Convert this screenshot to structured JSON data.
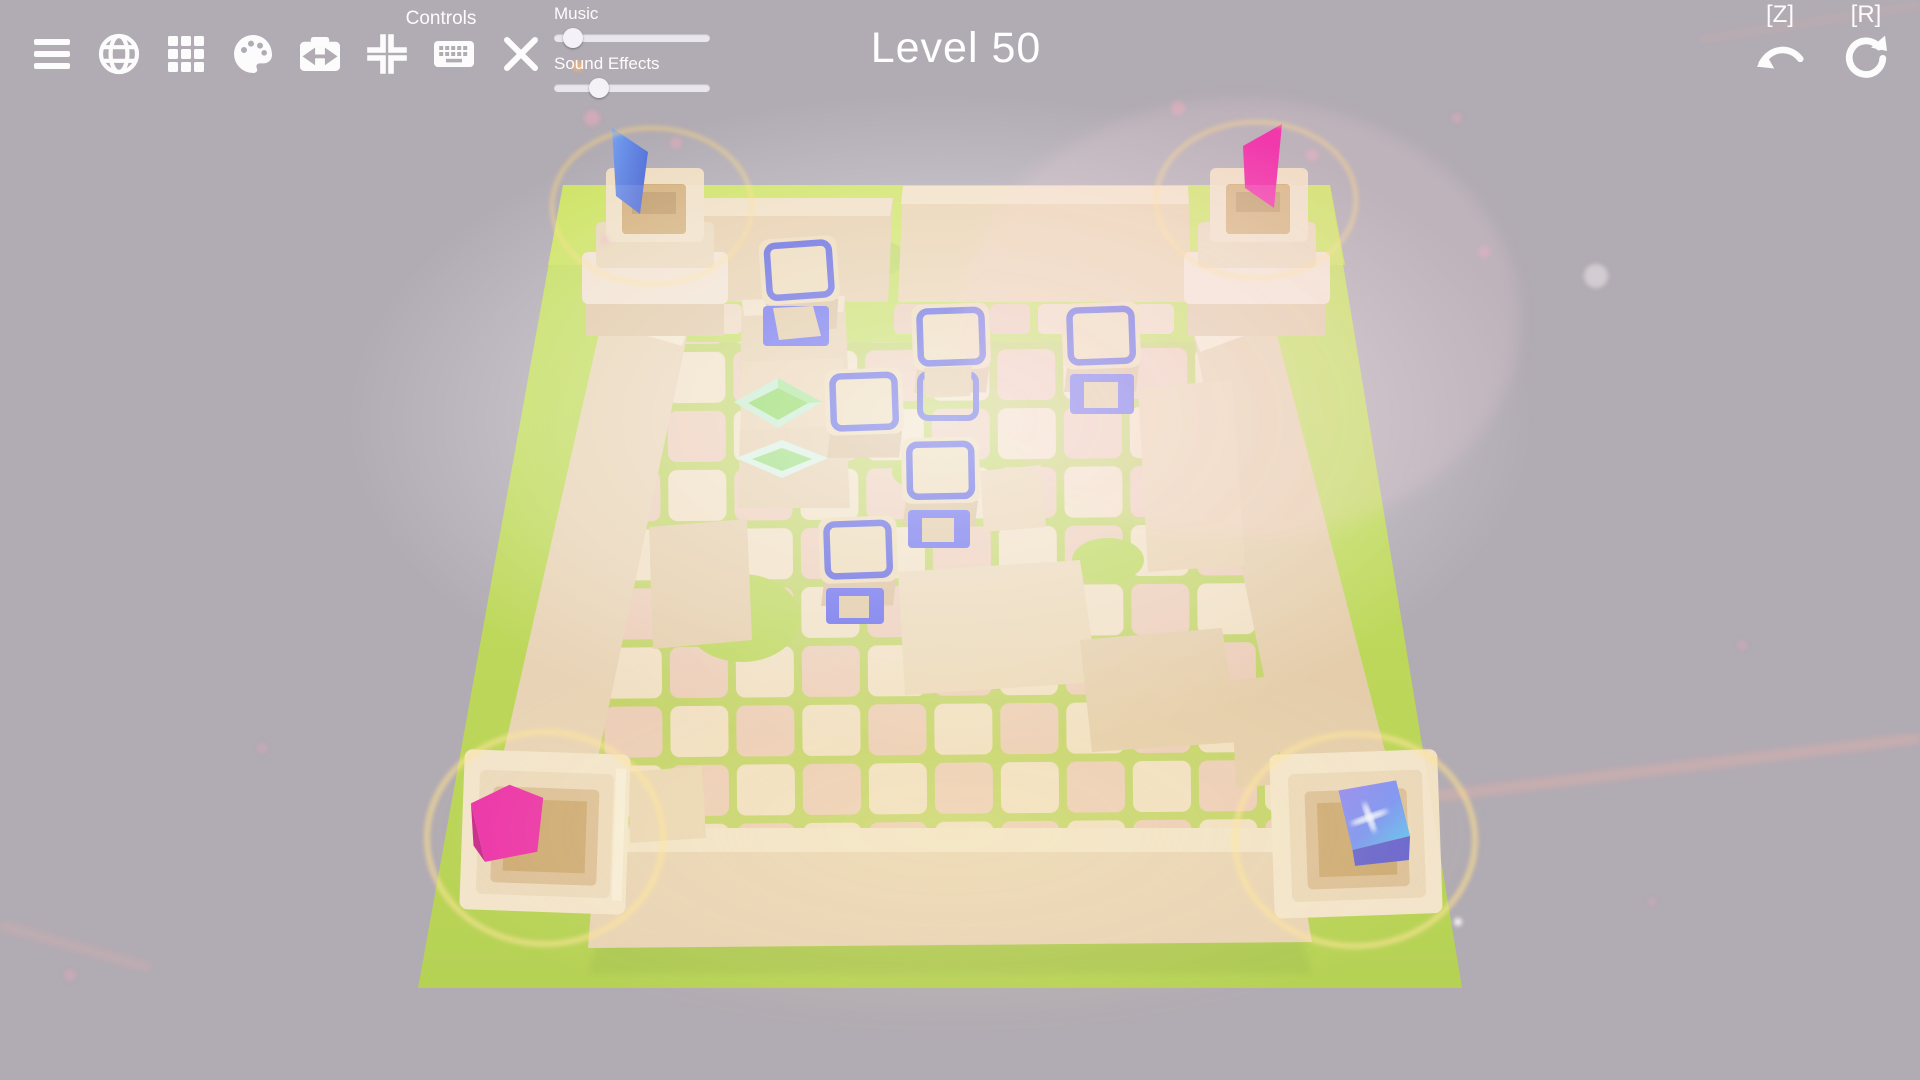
{
  "header": {
    "level_title": "Level 50"
  },
  "toolbar": {
    "controls_label": "Controls",
    "icons": [
      "menu",
      "globe",
      "grid",
      "palette",
      "camera-flip",
      "center-focus",
      "keyboard",
      "close"
    ]
  },
  "audio": {
    "music": {
      "label": "Music",
      "value_percent": 12
    },
    "sound_effects": {
      "label": "Sound Effects",
      "value_percent": 29
    }
  },
  "history": {
    "undo_key": "[Z]",
    "redo_key": "[R]"
  },
  "board": {
    "towers": [
      {
        "position": "top-left",
        "marker": "blue-flag"
      },
      {
        "position": "top-right",
        "marker": "pink-flag"
      },
      {
        "position": "bottom-left",
        "marker": "pink-pentagon-gem"
      },
      {
        "position": "bottom-right",
        "marker": "blue-portal-cube"
      }
    ],
    "blue_framed_cubes": 7,
    "blue_sockets": 5,
    "green_gems": 2
  },
  "colors": {
    "background": "#b1abb3",
    "platform_green": "#b9d44a",
    "sandstone": "#e6cfae",
    "tile_cream": "#efdcbd",
    "tile_pink": "#eac7b0",
    "frame_blue": "#4a4fd8",
    "flag_blue": "#4f74e0",
    "flag_pink": "#ec1f9e",
    "gem_green": "#7ed348",
    "glow_yellow": "#ffd97e",
    "ui_white": "#fdfcfd"
  }
}
